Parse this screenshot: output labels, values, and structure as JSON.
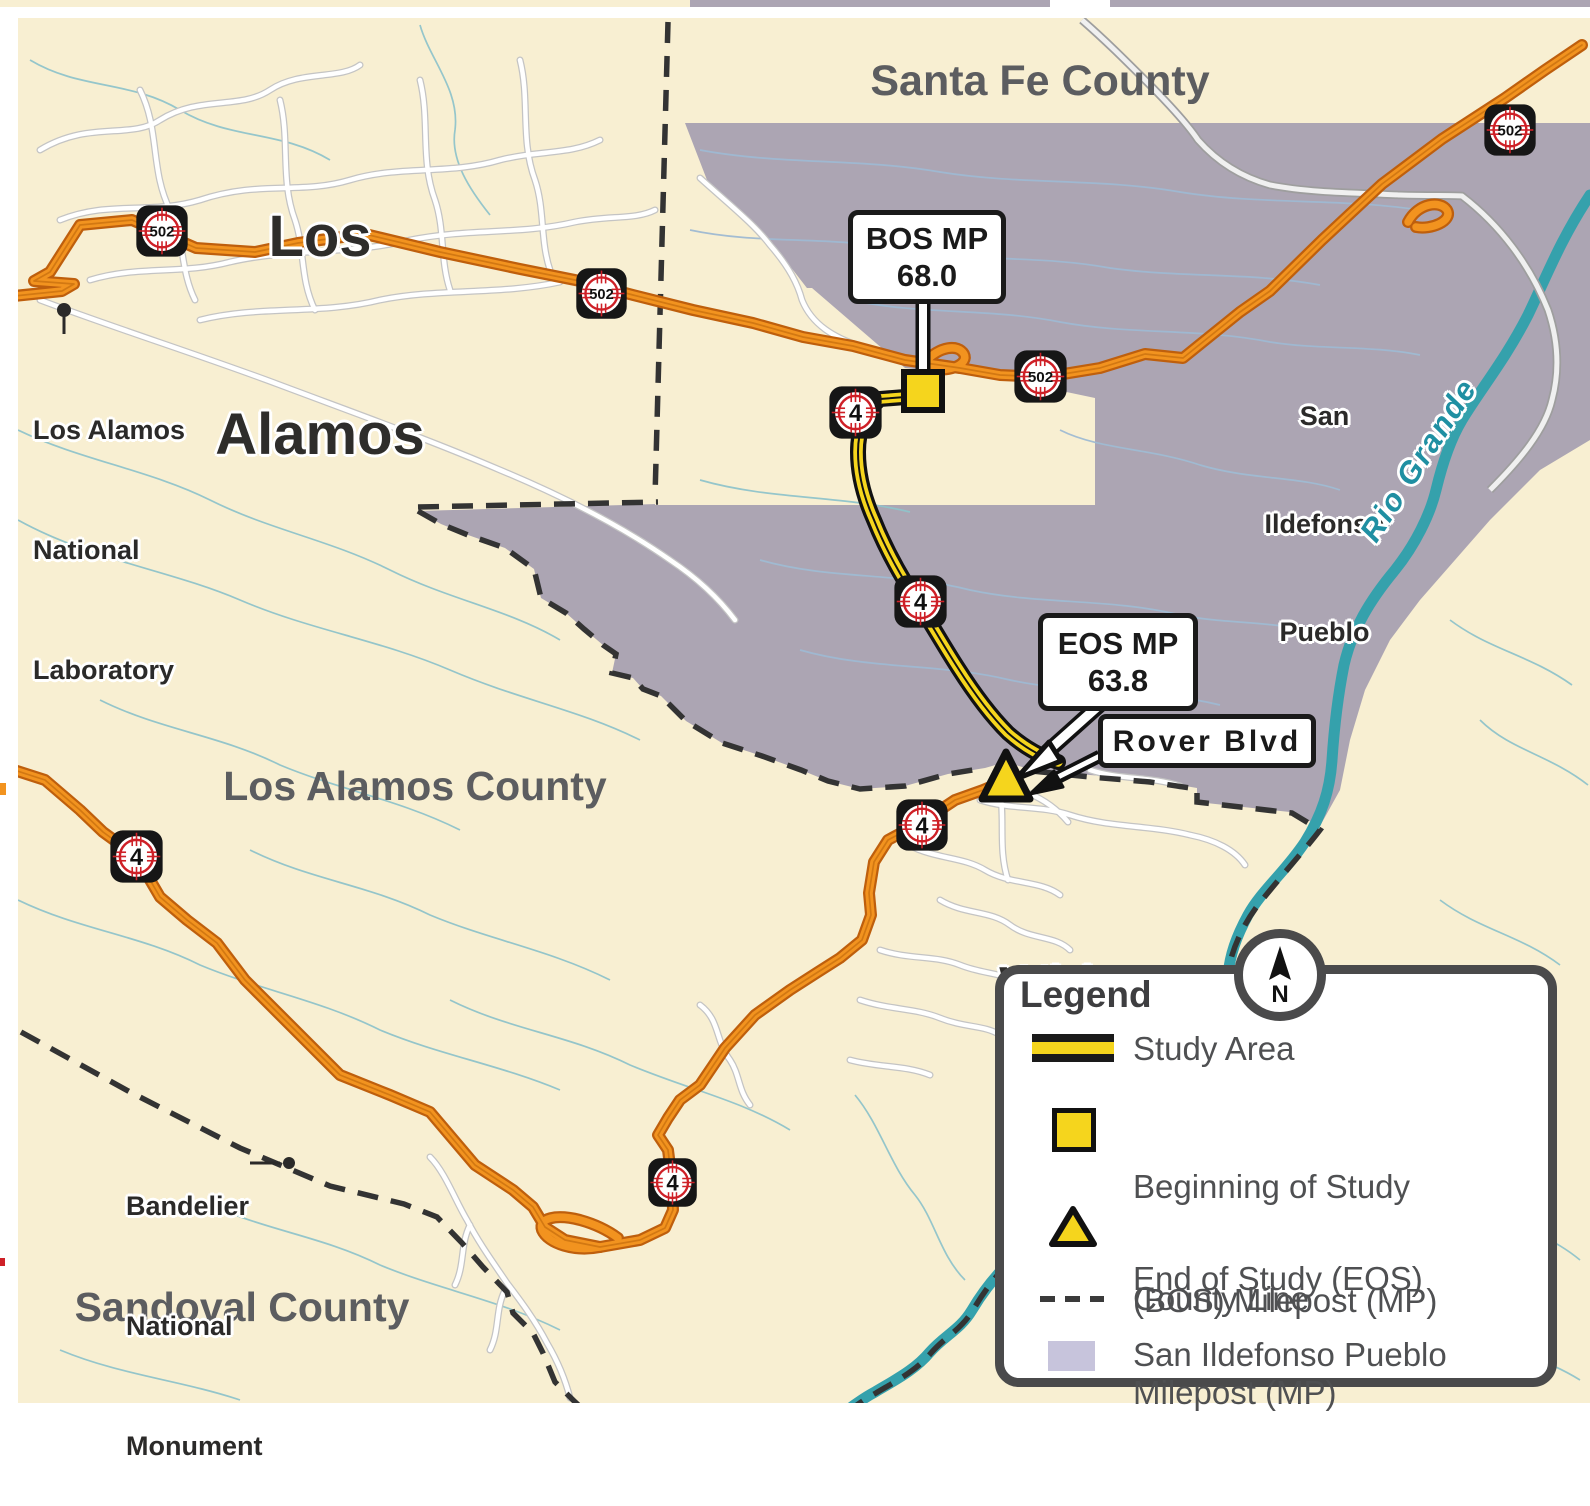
{
  "map": {
    "place_labels": {
      "los_alamos": {
        "line1": "Los",
        "line2": "Alamos"
      },
      "white_rock": {
        "line1": "White",
        "line2": "Rock"
      }
    },
    "county_labels": {
      "santa_fe": "Santa Fe County",
      "los_alamos": "Los Alamos County",
      "sandoval": "Sandoval County"
    },
    "area_labels": {
      "san_ildefonso": {
        "line1": "San",
        "line2": "Ildefonso",
        "line3": "Pueblo"
      }
    },
    "water_labels": {
      "rio_grande": "Rio Grande"
    },
    "poi_labels": {
      "lanl": {
        "line1": "Los Alamos",
        "line2": "National",
        "line3": "Laboratory"
      },
      "bandelier": {
        "line1": "Bandelier",
        "line2": "National",
        "line3": "Monument"
      }
    },
    "callouts": {
      "bos": {
        "title": "BOS MP",
        "value": "68.0"
      },
      "eos": {
        "title": "EOS MP",
        "value": "63.8"
      },
      "rover": {
        "label": "Rover Blvd"
      }
    },
    "route_shields": [
      {
        "route": "502",
        "x": 162,
        "y": 231,
        "size": 56
      },
      {
        "route": "502",
        "x": 601,
        "y": 293,
        "size": 55
      },
      {
        "route": "502",
        "x": 1510,
        "y": 130,
        "size": 56
      },
      {
        "route": "502",
        "x": 1040,
        "y": 376,
        "size": 57
      },
      {
        "route": "4",
        "x": 855,
        "y": 412,
        "size": 57
      },
      {
        "route": "4",
        "x": 920,
        "y": 601,
        "size": 57
      },
      {
        "route": "4",
        "x": 922,
        "y": 825,
        "size": 56
      },
      {
        "route": "4",
        "x": 136,
        "y": 856,
        "size": 57
      },
      {
        "route": "4",
        "x": 672,
        "y": 1182,
        "size": 53
      }
    ],
    "legend": {
      "title": "Legend",
      "study_area": "Study Area",
      "bos_line1": "Beginning of Study",
      "bos_line2": "(BOS) Milepost (MP)",
      "eos_line1": "End of Study (EOS)",
      "eos_line2": "Milepost (MP)",
      "county_line": "County Line",
      "pueblo": "San Ildefonso Pueblo"
    },
    "compass": {
      "label": "N"
    },
    "colors": {
      "cream": "#F8EFD2",
      "pueblo_fill": "#ACA5B3",
      "pueblo_legend_swatch": "#C7C4DC",
      "road_orange": "#F2931F",
      "road_orange_casing": "#BE5F0D",
      "study_yellow": "#F5D51D",
      "river_teal": "#35A1AC",
      "stream_teal": "#8FC3CA",
      "county_line_gray": "#3A3A3A",
      "county_label_gray": "#5C5D60",
      "place_label_black": "#2E2D2B",
      "shield_red": "#CE2027"
    }
  }
}
